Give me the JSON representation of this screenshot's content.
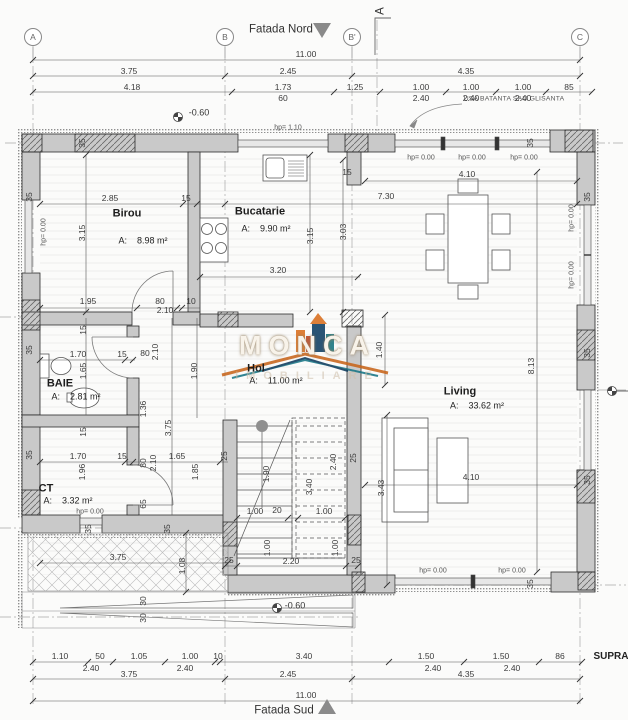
{
  "facades": {
    "north": "Fatada Nord",
    "south": "Fatada Sud"
  },
  "grid_axes": [
    "A",
    "B",
    "B'",
    "C"
  ],
  "section_marker": "A",
  "notes": {
    "door_type": "USA BATANTA SAU GLISANTA",
    "corner_text": "SUPRA"
  },
  "levels": [
    "-0.60",
    "-0.60"
  ],
  "watermark": {
    "brand": "MONCA",
    "sub": "IMOBILIARE"
  },
  "rooms": [
    {
      "name": "Birou",
      "area": "8.98 m²"
    },
    {
      "name": "Bucatarie",
      "area": "9.90 m²"
    },
    {
      "name": "Hol",
      "area": "11.00 m²"
    },
    {
      "name": "BAIE",
      "area": "2.81 m²"
    },
    {
      "name": "CT",
      "area": "3.32 m²"
    },
    {
      "name": "Living",
      "area": "33.62 m²"
    }
  ],
  "dimension_rows": {
    "top": [
      [
        "11.00"
      ],
      [
        "3.75",
        "2.45",
        "4.35"
      ],
      [
        "4.18",
        "1.73",
        "1.25",
        "1.00",
        "1.00",
        "1.00",
        "85"
      ],
      [
        "60",
        "2.40",
        "2.40",
        "2.40"
      ]
    ],
    "bottom": [
      [
        "1.10",
        "50",
        "1.05",
        "1.00",
        "10",
        "3.40",
        "1.50",
        "1.50",
        "86"
      ],
      [
        "2.40",
        "2.40",
        "2.40",
        "2.40"
      ],
      [
        "3.75",
        "2.45",
        "4.35"
      ],
      [
        "11.00"
      ]
    ]
  },
  "labels": [
    {
      "t": "Fatada Nord",
      "x": 281,
      "y": 30,
      "c": "h",
      "n": "facade-north-label"
    },
    {
      "t": "Fatada Sud",
      "x": 284,
      "y": 711,
      "c": "h",
      "n": "facade-south-label"
    },
    {
      "t": "SUPRA",
      "x": 611,
      "y": 657,
      "c": "sup",
      "n": "supra-label"
    },
    {
      "t": "A",
      "x": 33,
      "y": 37,
      "c": "b",
      "n": "grid-bubble-a"
    },
    {
      "t": "B",
      "x": 225,
      "y": 37,
      "c": "b",
      "n": "grid-bubble-b"
    },
    {
      "t": "B'",
      "x": 352,
      "y": 37,
      "c": "b",
      "n": "grid-bubble-b-prime"
    },
    {
      "t": "C",
      "x": 580,
      "y": 37,
      "c": "b",
      "n": "grid-bubble-c"
    },
    {
      "t": "A",
      "x": 381,
      "y": 11,
      "c": "h",
      "r": 1,
      "n": "section-marker-a"
    },
    {
      "t": "USA BATANTA SAU GLISANTA",
      "x": 514,
      "y": 100,
      "c": "n",
      "n": "door-type-note"
    },
    {
      "t": "-0.60",
      "x": 199,
      "y": 113,
      "c": "l",
      "n": "level-marker-label"
    },
    {
      "t": "-0.60",
      "x": 295,
      "y": 606,
      "c": "l",
      "n": "level-marker-label"
    },
    {
      "t": "hp= 1.10",
      "x": 288,
      "y": 128,
      "c": "s"
    },
    {
      "t": "hp= 0.00",
      "x": 421,
      "y": 158,
      "c": "s"
    },
    {
      "t": "hp= 0.00",
      "x": 472,
      "y": 158,
      "c": "s"
    },
    {
      "t": "hp= 0.00",
      "x": 524,
      "y": 158,
      "c": "s"
    },
    {
      "t": "hp= 0.00",
      "x": 433,
      "y": 571,
      "c": "s"
    },
    {
      "t": "hp= 0.00",
      "x": 512,
      "y": 571,
      "c": "s"
    },
    {
      "t": "hp= 0.00",
      "x": 90,
      "y": 512,
      "c": "s"
    },
    {
      "t": "hp= 0.00",
      "x": 44,
      "y": 232,
      "c": "s",
      "r": 1
    },
    {
      "t": "hp= 0.00",
      "x": 572,
      "y": 218,
      "c": "s",
      "r": 1
    },
    {
      "t": "hp= 0.00",
      "x": 572,
      "y": 275,
      "c": "s",
      "r": 1
    },
    {
      "t": "11.00",
      "x": 306,
      "y": 54,
      "c": "d"
    },
    {
      "t": "3.75",
      "x": 129,
      "y": 71,
      "c": "d"
    },
    {
      "t": "2.45",
      "x": 288,
      "y": 71,
      "c": "d"
    },
    {
      "t": "4.35",
      "x": 466,
      "y": 71,
      "c": "d"
    },
    {
      "t": "4.18",
      "x": 132,
      "y": 87,
      "c": "d"
    },
    {
      "t": "1.73",
      "x": 283,
      "y": 87,
      "c": "d"
    },
    {
      "t": "1.25",
      "x": 355,
      "y": 87,
      "c": "d"
    },
    {
      "t": "1.00",
      "x": 421,
      "y": 87,
      "c": "d"
    },
    {
      "t": "1.00",
      "x": 471,
      "y": 87,
      "c": "d"
    },
    {
      "t": "1.00",
      "x": 523,
      "y": 87,
      "c": "d"
    },
    {
      "t": "85",
      "x": 569,
      "y": 87,
      "c": "d"
    },
    {
      "t": "60",
      "x": 283,
      "y": 98,
      "c": "d"
    },
    {
      "t": "2.40",
      "x": 421,
      "y": 98,
      "c": "d"
    },
    {
      "t": "2.40",
      "x": 471,
      "y": 98,
      "c": "d"
    },
    {
      "t": "2.40",
      "x": 523,
      "y": 98,
      "c": "d"
    },
    {
      "t": "Birou",
      "x": 127,
      "y": 214,
      "c": "r",
      "n": "room-label-birou"
    },
    {
      "t": "A:    8.98 m²",
      "x": 143,
      "y": 241,
      "c": "a",
      "n": "room-area-birou"
    },
    {
      "t": "Bucatarie",
      "x": 260,
      "y": 212,
      "c": "r",
      "n": "room-label-bucatarie"
    },
    {
      "t": "A:    9.90 m²",
      "x": 266,
      "y": 229,
      "c": "a",
      "n": "room-area-bucatarie"
    },
    {
      "t": "Hol",
      "x": 256,
      "y": 369,
      "c": "r",
      "n": "room-label-hol"
    },
    {
      "t": "A:    11.00 m²",
      "x": 276,
      "y": 381,
      "c": "a",
      "n": "room-area-hol"
    },
    {
      "t": "BAIE",
      "x": 60,
      "y": 384,
      "c": "r",
      "n": "room-label-baie"
    },
    {
      "t": "A:    2.81 m²",
      "x": 76,
      "y": 397,
      "c": "a",
      "n": "room-area-baie"
    },
    {
      "t": "CT",
      "x": 46,
      "y": 489,
      "c": "r",
      "n": "room-label-ct"
    },
    {
      "t": "A:    3.32 m²",
      "x": 68,
      "y": 501,
      "c": "a",
      "n": "room-area-ct"
    },
    {
      "t": "Living",
      "x": 460,
      "y": 392,
      "c": "r",
      "n": "room-label-living"
    },
    {
      "t": "A:    33.62 m²",
      "x": 477,
      "y": 406,
      "c": "a",
      "n": "room-area-living"
    },
    {
      "t": "2.85",
      "x": 110,
      "y": 198,
      "c": "d"
    },
    {
      "t": "15",
      "x": 186,
      "y": 198,
      "c": "d"
    },
    {
      "t": "3.15",
      "x": 82,
      "y": 233,
      "c": "d",
      "r": 1
    },
    {
      "t": "3.20",
      "x": 278,
      "y": 270,
      "c": "d"
    },
    {
      "t": "3.15",
      "x": 310,
      "y": 236,
      "c": "d",
      "r": 1
    },
    {
      "t": "3.03",
      "x": 343,
      "y": 232,
      "c": "d",
      "r": 1
    },
    {
      "t": "15",
      "x": 347,
      "y": 172,
      "c": "d"
    },
    {
      "t": "7.30",
      "x": 386,
      "y": 196,
      "c": "d"
    },
    {
      "t": "4.10",
      "x": 467,
      "y": 174,
      "c": "d"
    },
    {
      "t": "4.10",
      "x": 471,
      "y": 477,
      "c": "d"
    },
    {
      "t": "8.13",
      "x": 531,
      "y": 366,
      "c": "d",
      "r": 1
    },
    {
      "t": "1.40",
      "x": 379,
      "y": 350,
      "c": "d",
      "r": 1
    },
    {
      "t": "3.43",
      "x": 381,
      "y": 488,
      "c": "d",
      "r": 1
    },
    {
      "t": "1.95",
      "x": 88,
      "y": 301,
      "c": "d"
    },
    {
      "t": "80",
      "x": 160,
      "y": 301,
      "c": "d"
    },
    {
      "t": "10",
      "x": 191,
      "y": 301,
      "c": "d"
    },
    {
      "t": "2.10",
      "x": 165,
      "y": 310,
      "c": "d"
    },
    {
      "t": "1.70",
      "x": 78,
      "y": 354,
      "c": "d"
    },
    {
      "t": "15",
      "x": 122,
      "y": 354,
      "c": "d"
    },
    {
      "t": "80",
      "x": 145,
      "y": 353,
      "c": "d"
    },
    {
      "t": "2.10",
      "x": 155,
      "y": 352,
      "c": "d",
      "r": 1
    },
    {
      "t": "1.65",
      "x": 83,
      "y": 371,
      "c": "d",
      "r": 1
    },
    {
      "t": "1.90",
      "x": 194,
      "y": 371,
      "c": "d",
      "r": 1
    },
    {
      "t": "1.36",
      "x": 143,
      "y": 409,
      "c": "d",
      "r": 1
    },
    {
      "t": "3.75",
      "x": 168,
      "y": 428,
      "c": "d",
      "r": 1
    },
    {
      "t": "15",
      "x": 83,
      "y": 330,
      "c": "d",
      "r": 1
    },
    {
      "t": "15",
      "x": 83,
      "y": 432,
      "c": "d",
      "r": 1
    },
    {
      "t": "1.70",
      "x": 78,
      "y": 456,
      "c": "d"
    },
    {
      "t": "15",
      "x": 122,
      "y": 456,
      "c": "d"
    },
    {
      "t": "1.65",
      "x": 177,
      "y": 456,
      "c": "d"
    },
    {
      "t": "1.96",
      "x": 82,
      "y": 472,
      "c": "d",
      "r": 1
    },
    {
      "t": "80",
      "x": 143,
      "y": 463,
      "c": "d",
      "r": 1
    },
    {
      "t": "2.10",
      "x": 153,
      "y": 463,
      "c": "d",
      "r": 1
    },
    {
      "t": "1.85",
      "x": 195,
      "y": 472,
      "c": "d",
      "r": 1
    },
    {
      "t": "65",
      "x": 143,
      "y": 504,
      "c": "d",
      "r": 1
    },
    {
      "t": "3.75",
      "x": 118,
      "y": 557,
      "c": "d"
    },
    {
      "t": "1.08",
      "x": 182,
      "y": 566,
      "c": "d",
      "r": 1
    },
    {
      "t": "30",
      "x": 143,
      "y": 601,
      "c": "d",
      "r": 1
    },
    {
      "t": "30",
      "x": 143,
      "y": 618,
      "c": "d",
      "r": 1
    },
    {
      "t": "1.00",
      "x": 255,
      "y": 511,
      "c": "d"
    },
    {
      "t": "20",
      "x": 277,
      "y": 510,
      "c": "d"
    },
    {
      "t": "1.00",
      "x": 324,
      "y": 511,
      "c": "d"
    },
    {
      "t": "1.90",
      "x": 266,
      "y": 474,
      "c": "d",
      "r": 1
    },
    {
      "t": "2.40",
      "x": 333,
      "y": 462,
      "c": "d",
      "r": 1
    },
    {
      "t": "3.40",
      "x": 309,
      "y": 487,
      "c": "d",
      "r": 1
    },
    {
      "t": "1.00",
      "x": 267,
      "y": 548,
      "c": "d",
      "r": 1
    },
    {
      "t": "1.00",
      "x": 335,
      "y": 548,
      "c": "d",
      "r": 1
    },
    {
      "t": "2.20",
      "x": 291,
      "y": 561,
      "c": "d"
    },
    {
      "t": "25",
      "x": 229,
      "y": 560,
      "c": "d"
    },
    {
      "t": "25",
      "x": 356,
      "y": 560,
      "c": "d"
    },
    {
      "t": "25",
      "x": 224,
      "y": 456,
      "c": "d",
      "r": 1
    },
    {
      "t": "25",
      "x": 353,
      "y": 458,
      "c": "d",
      "r": 1
    },
    {
      "t": "35",
      "x": 82,
      "y": 143,
      "c": "d",
      "r": 1
    },
    {
      "t": "35",
      "x": 530,
      "y": 143,
      "c": "d",
      "r": 1
    },
    {
      "t": "35",
      "x": 29,
      "y": 197,
      "c": "d",
      "r": 1
    },
    {
      "t": "35",
      "x": 29,
      "y": 350,
      "c": "d",
      "r": 1
    },
    {
      "t": "35",
      "x": 29,
      "y": 455,
      "c": "d",
      "r": 1
    },
    {
      "t": "35",
      "x": 587,
      "y": 197,
      "c": "d",
      "r": 1
    },
    {
      "t": "35",
      "x": 587,
      "y": 353,
      "c": "d",
      "r": 1
    },
    {
      "t": "35",
      "x": 587,
      "y": 480,
      "c": "d",
      "r": 1
    },
    {
      "t": "35",
      "x": 530,
      "y": 584,
      "c": "d",
      "r": 1
    },
    {
      "t": "35",
      "x": 88,
      "y": 529,
      "c": "d",
      "r": 1
    },
    {
      "t": "35",
      "x": 167,
      "y": 529,
      "c": "d",
      "r": 1
    },
    {
      "t": "1.10",
      "x": 60,
      "y": 656,
      "c": "d"
    },
    {
      "t": "50",
      "x": 100,
      "y": 656,
      "c": "d"
    },
    {
      "t": "1.05",
      "x": 139,
      "y": 656,
      "c": "d"
    },
    {
      "t": "1.00",
      "x": 190,
      "y": 656,
      "c": "d"
    },
    {
      "t": "10",
      "x": 218,
      "y": 656,
      "c": "d"
    },
    {
      "t": "3.40",
      "x": 304,
      "y": 656,
      "c": "d"
    },
    {
      "t": "1.50",
      "x": 426,
      "y": 656,
      "c": "d"
    },
    {
      "t": "1.50",
      "x": 501,
      "y": 656,
      "c": "d"
    },
    {
      "t": "86",
      "x": 560,
      "y": 656,
      "c": "d"
    },
    {
      "t": "2.40",
      "x": 91,
      "y": 668,
      "c": "d"
    },
    {
      "t": "2.40",
      "x": 185,
      "y": 668,
      "c": "d"
    },
    {
      "t": "2.40",
      "x": 433,
      "y": 668,
      "c": "d"
    },
    {
      "t": "2.40",
      "x": 512,
      "y": 668,
      "c": "d"
    },
    {
      "t": "3.75",
      "x": 129,
      "y": 674,
      "c": "d"
    },
    {
      "t": "2.45",
      "x": 288,
      "y": 674,
      "c": "d"
    },
    {
      "t": "4.35",
      "x": 466,
      "y": 674,
      "c": "d"
    },
    {
      "t": "11.00",
      "x": 306,
      "y": 695,
      "c": "d"
    }
  ]
}
